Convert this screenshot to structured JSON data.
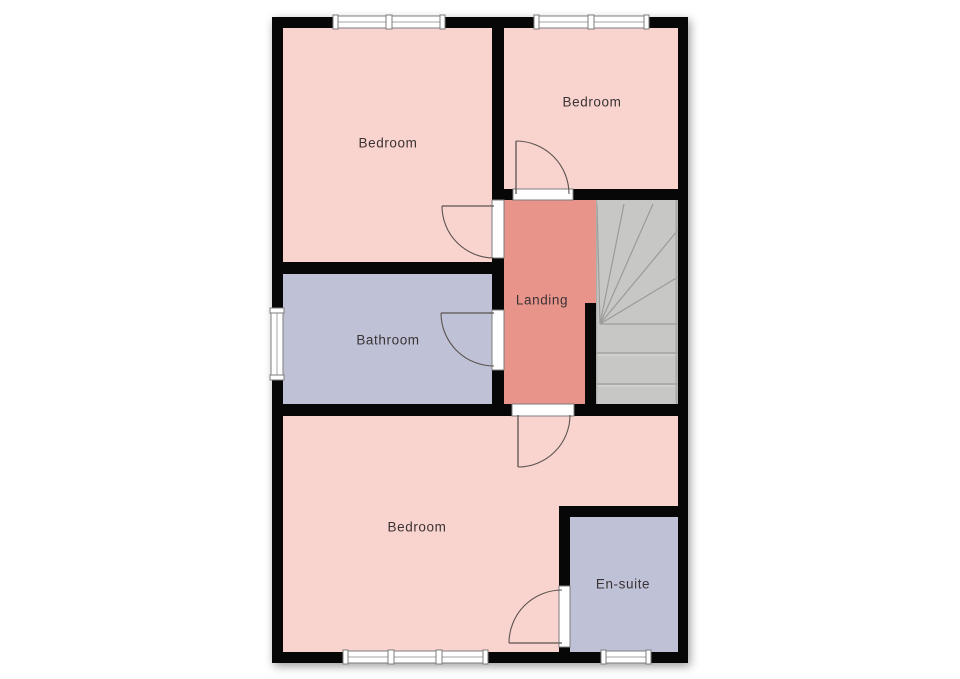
{
  "page": {
    "background": "#ffffff"
  },
  "colors": {
    "wall": "#070707",
    "room_pink": "#f9d3ce",
    "landing_salmon": "#e9948a",
    "wet_room_lavender": "#bfc2d6",
    "stair_fill": "#c7c7c5",
    "stair_line": "#9b9b99",
    "stair_highlight": "#d8d8d6",
    "stair_edge": "#a8a8a6",
    "door_line": "#5c5350",
    "window_border": "#7d7d7d",
    "window_glaze": "#a5a5a5",
    "window_fill": "#ffffff",
    "label_text": "#3a3335"
  },
  "plan": {
    "outer": [
      272,
      17,
      416,
      646
    ],
    "wall_thickness": 11
  },
  "rooms": [
    {
      "name": "bedroom-front",
      "label": "Bedroom",
      "rect": [
        283,
        28,
        210,
        234
      ],
      "color_key": "room_pink",
      "label_xy": [
        388,
        143
      ]
    },
    {
      "name": "bedroom-back",
      "label": "Bedroom",
      "rect": [
        504,
        28,
        174,
        161
      ],
      "color_key": "room_pink",
      "label_xy": [
        592,
        102
      ]
    },
    {
      "name": "landing",
      "label": "Landing",
      "rect": [
        504,
        200,
        92,
        204
      ],
      "color_key": "landing_salmon",
      "label_xy": [
        542,
        300
      ]
    },
    {
      "name": "bathroom",
      "label": "Bathroom",
      "rect": [
        283,
        274,
        210,
        130
      ],
      "color_key": "wet_room_lavender",
      "label_xy": [
        388,
        340
      ]
    },
    {
      "name": "bedroom-main",
      "label": "Bedroom",
      "rect": [
        283,
        416,
        395,
        236
      ],
      "color_key": "room_pink",
      "label_xy": [
        417,
        527
      ]
    },
    {
      "name": "ensuite",
      "label": "En-suite",
      "rect": [
        570,
        517,
        108,
        135
      ],
      "color_key": "wet_room_lavender",
      "label_xy": [
        623,
        584
      ]
    }
  ],
  "stairs": {
    "rect": [
      596,
      200,
      82,
      204
    ],
    "fan_center": [
      600,
      324
    ],
    "winder_ends": [
      [
        597,
        204
      ],
      [
        624,
        204
      ],
      [
        653,
        204
      ],
      [
        678,
        230
      ],
      [
        678,
        277
      ],
      [
        678,
        324
      ]
    ],
    "tread_ys": [
      353,
      384
    ]
  },
  "walls": [
    {
      "name": "wall-bedrooms-divider",
      "rect": [
        492,
        17,
        12,
        399
      ]
    },
    {
      "name": "wall-bedroom-back-landing",
      "rect": [
        504,
        189,
        174,
        11
      ]
    },
    {
      "name": "wall-bedroom-front-bathroom",
      "rect": [
        272,
        262,
        232,
        12
      ]
    },
    {
      "name": "wall-landing-bedroom-main",
      "rect": [
        272,
        404,
        416,
        12
      ]
    },
    {
      "name": "wall-landing-stairs-stub",
      "rect": [
        585,
        303,
        11,
        113
      ]
    },
    {
      "name": "wall-ensuite-top",
      "rect": [
        559,
        506,
        129,
        11
      ]
    },
    {
      "name": "wall-ensuite-left",
      "rect": [
        559,
        506,
        11,
        157
      ]
    }
  ],
  "windows": [
    {
      "name": "window-bedroom-front",
      "rect": [
        333,
        16,
        112,
        12
      ],
      "orient": "h",
      "dividers": [
        389
      ]
    },
    {
      "name": "window-bedroom-back",
      "rect": [
        534,
        16,
        115,
        12
      ],
      "orient": "h",
      "dividers": [
        591
      ]
    },
    {
      "name": "window-bathroom",
      "rect": [
        271,
        308,
        12,
        72
      ],
      "orient": "v",
      "dividers": []
    },
    {
      "name": "window-bedroom-main",
      "rect": [
        343,
        651,
        145,
        12
      ],
      "orient": "h",
      "dividers": [
        391,
        439
      ]
    },
    {
      "name": "window-ensuite",
      "rect": [
        601,
        651,
        50,
        12
      ],
      "orient": "h",
      "dividers": []
    }
  ],
  "doors": [
    {
      "name": "door-bedroom-back",
      "jamb": [
        513,
        189,
        60,
        11
      ],
      "leaf": [
        [
          516,
          194
        ],
        [
          516,
          141
        ]
      ],
      "arc": "M516,141 A53,53 0 0 1 569,194"
    },
    {
      "name": "door-bedroom-front",
      "jamb": [
        492,
        200,
        12,
        58
      ],
      "leaf": [
        [
          494,
          206
        ],
        [
          442,
          206
        ]
      ],
      "arc": "M442,206 A52,52 0 0 0 494,258"
    },
    {
      "name": "door-bathroom",
      "jamb": [
        492,
        310,
        12,
        60
      ],
      "leaf": [
        [
          494,
          313
        ],
        [
          441,
          313
        ]
      ],
      "arc": "M441,313 A53,53 0 0 0 494,366"
    },
    {
      "name": "door-bedroom-main",
      "jamb": [
        512,
        404,
        62,
        12
      ],
      "leaf": [
        [
          518,
          415
        ],
        [
          518,
          467
        ]
      ],
      "arc": "M518,467 A52,52 0 0 0 570,415"
    },
    {
      "name": "door-ensuite",
      "jamb": [
        559,
        586,
        11,
        61
      ],
      "leaf": [
        [
          562,
          643
        ],
        [
          509,
          643
        ]
      ],
      "arc": "M509,643 A53,53 0 0 1 562,590"
    }
  ]
}
